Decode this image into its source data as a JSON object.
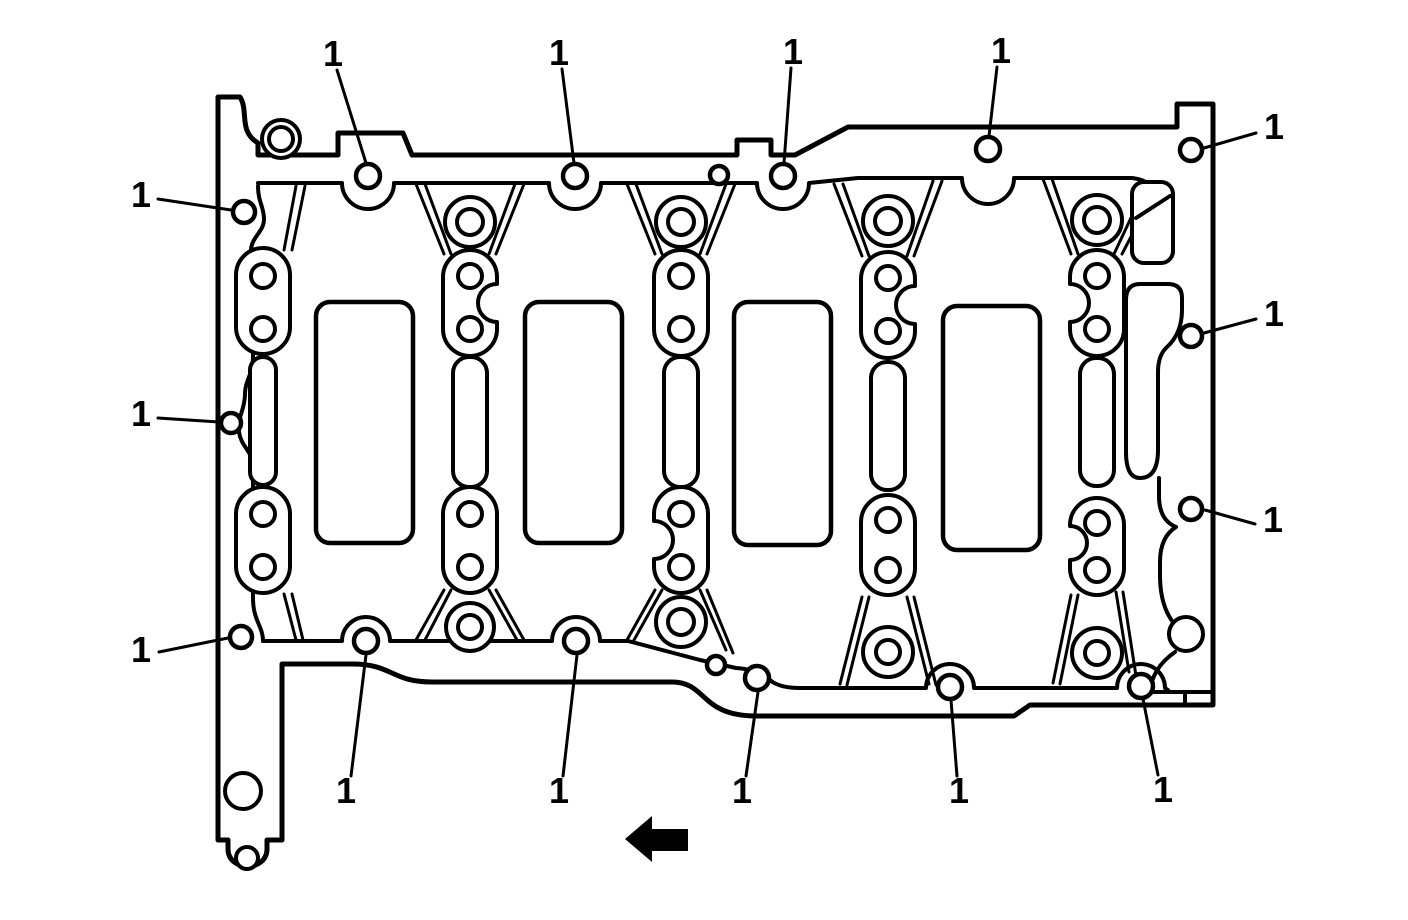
{
  "figure": {
    "type": "technical-line-illustration",
    "subject": "Engine block lower (oil pan rail) sealing surface with bolt hole callouts",
    "style": "black line art on white"
  },
  "colors": {
    "line": "#000000",
    "background": "#ffffff"
  },
  "callouts": [
    {
      "label": "1",
      "text_x": 333,
      "text_y": 66,
      "x1": 337,
      "y1": 70,
      "x2": 366,
      "y2": 163
    },
    {
      "label": "1",
      "text_x": 559,
      "text_y": 65,
      "x1": 562,
      "y1": 69,
      "x2": 574,
      "y2": 163
    },
    {
      "label": "1",
      "text_x": 793,
      "text_y": 64,
      "x1": 791,
      "y1": 68,
      "x2": 784,
      "y2": 163
    },
    {
      "label": "1",
      "text_x": 1001,
      "text_y": 63,
      "x1": 997,
      "y1": 67,
      "x2": 989,
      "y2": 136
    },
    {
      "label": "1",
      "text_x": 1274,
      "text_y": 139,
      "x1": 1256,
      "y1": 133,
      "x2": 1204,
      "y2": 148
    },
    {
      "label": "1",
      "text_x": 1274,
      "text_y": 326,
      "x1": 1256,
      "y1": 319,
      "x2": 1204,
      "y2": 333
    },
    {
      "label": "1",
      "text_x": 1273,
      "text_y": 532,
      "x1": 1255,
      "y1": 524,
      "x2": 1205,
      "y2": 510
    },
    {
      "label": "1",
      "text_x": 141,
      "text_y": 207,
      "x1": 158,
      "y1": 199,
      "x2": 231,
      "y2": 210
    },
    {
      "label": "1",
      "text_x": 141,
      "text_y": 426,
      "x1": 158,
      "y1": 418,
      "x2": 219,
      "y2": 422
    },
    {
      "label": "1",
      "text_x": 141,
      "text_y": 662,
      "x1": 159,
      "y1": 652,
      "x2": 228,
      "y2": 638
    },
    {
      "label": "1",
      "text_x": 346,
      "text_y": 803,
      "x1": 351,
      "y1": 776,
      "x2": 366,
      "y2": 655
    },
    {
      "label": "1",
      "text_x": 559,
      "text_y": 803,
      "x1": 563,
      "y1": 776,
      "x2": 577,
      "y2": 655
    },
    {
      "label": "1",
      "text_x": 742,
      "text_y": 803,
      "x1": 746,
      "y1": 776,
      "x2": 758,
      "y2": 692
    },
    {
      "label": "1",
      "text_x": 959,
      "text_y": 803,
      "x1": 957,
      "y1": 776,
      "x2": 951,
      "y2": 700
    },
    {
      "label": "1",
      "text_x": 1163,
      "text_y": 802,
      "x1": 1158,
      "y1": 775,
      "x2": 1143,
      "y2": 699
    }
  ],
  "direction_arrow": {
    "meaning": "front-of-engine direction",
    "direction": "left"
  }
}
